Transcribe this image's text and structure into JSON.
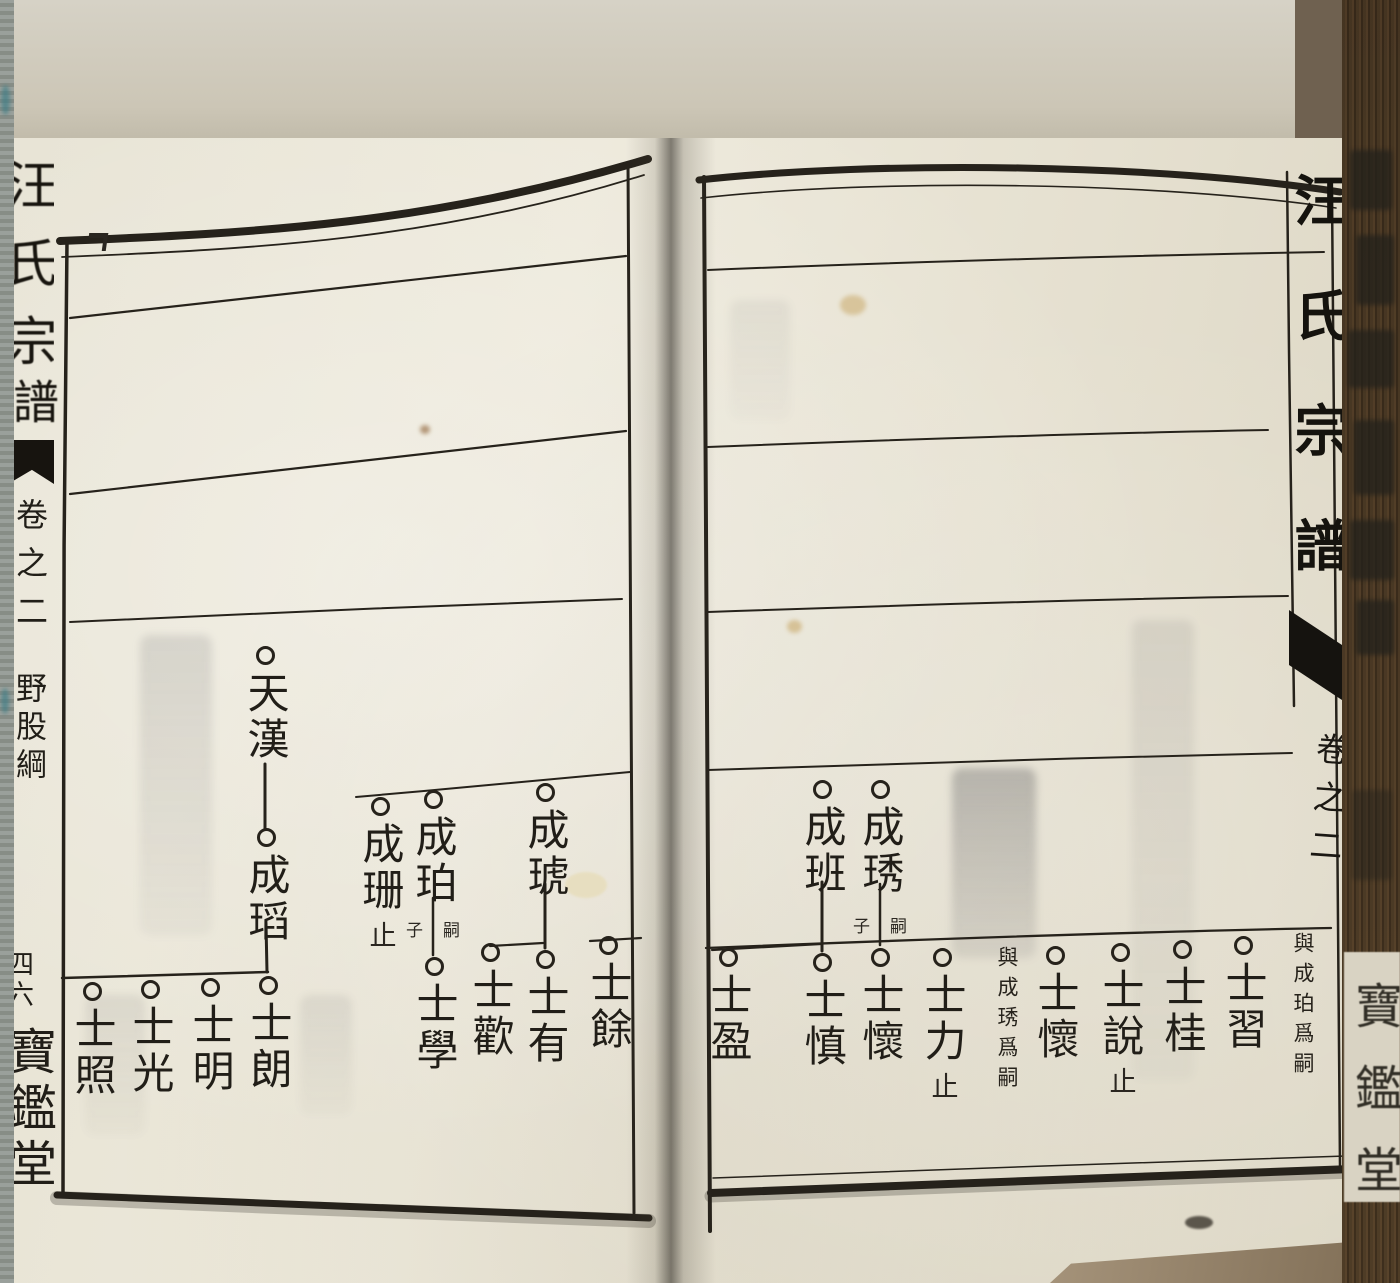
{
  "palette": {
    "backdrop": "#cdc8b9",
    "paper": "#e9e5d6",
    "ink": "#211e18",
    "page_edge_brown": "#8a7660",
    "fabric_gray": "#9aa09b"
  },
  "left_margin": {
    "spine_title_upper": "汪氏宗",
    "spine_title_lower": "譜",
    "volume": "卷之二",
    "branch_label": "野股綱",
    "page_number": "四六",
    "hall_name": "寶鑑堂"
  },
  "right_margin": {
    "spine_title": "汪氏宗譜",
    "volume": "卷之二",
    "edge_hall_name": "寶鑑堂"
  },
  "left_page": {
    "persons": [
      {
        "name": "天漢"
      },
      {
        "name": "成瑫"
      },
      {
        "name": "成珊",
        "suffix": "止"
      },
      {
        "name": "成珀",
        "line_note_left": "子",
        "line_note_right": "嗣"
      },
      {
        "name": "成琥"
      },
      {
        "name": "士餘"
      },
      {
        "name": "士有"
      },
      {
        "name": "士歡"
      },
      {
        "name": "士學"
      },
      {
        "name": "士朗"
      },
      {
        "name": "士明"
      },
      {
        "name": "士光"
      },
      {
        "name": "士照"
      }
    ]
  },
  "right_page": {
    "persons": [
      {
        "name": "成琇",
        "line_note_left": "子",
        "line_note_right": "嗣"
      },
      {
        "name": "成班"
      },
      {
        "name": "士盈"
      },
      {
        "name": "士慎"
      },
      {
        "name": "士懷"
      },
      {
        "name": "士力",
        "suffix": "止"
      },
      {
        "name": "士懷",
        "side_note": "與成琇爲嗣"
      },
      {
        "name": "士說",
        "suffix": "止"
      },
      {
        "name": "士桂"
      },
      {
        "name": "士習"
      }
    ],
    "standalone_note": "與成珀爲嗣"
  }
}
